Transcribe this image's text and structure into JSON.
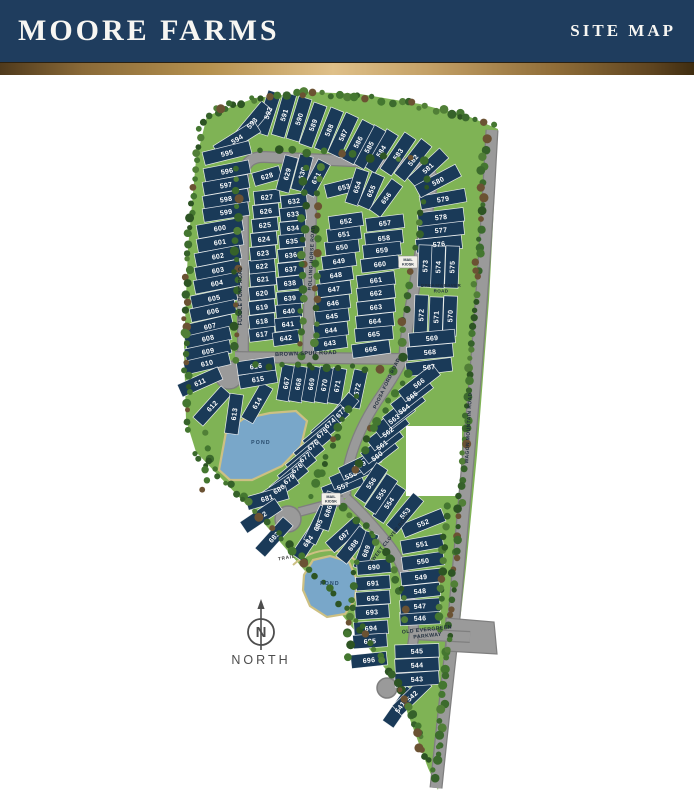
{
  "header": {
    "title": "MOORE FARMS",
    "subtitle": "SITE MAP"
  },
  "colors": {
    "header_bg": "#1f3d5e",
    "lot_fill": "#1a3a58",
    "lot_line": "#ffffff",
    "road": "#9a9a9a",
    "road_edge": "#7f7f7f",
    "grass": "#7fb355",
    "pond": "#79a7c9",
    "pond_edge": "#cdc083",
    "label_dark": "#1f2d3c",
    "compass": "#4d4d4d",
    "gold": "#c9a56b"
  },
  "map": {
    "north_label": "NORTH",
    "pond_label": "POND",
    "trail_label": "TRAIL",
    "mail_kiosk_label": "MAIL KIOSK",
    "roads": [
      {
        "id": "fuddle-pond-road",
        "name": "FUDDLE POND ROAD"
      },
      {
        "id": "rolling-horse-road",
        "name": "ROLLING HORSE ROAD"
      },
      {
        "id": "brown-spur-road",
        "name": "BROWN SPUR ROAD"
      },
      {
        "id": "poosa-ford-road",
        "name": "POOSA FORD ROAD"
      },
      {
        "id": "dreamweaver-road",
        "name": "DREAMWEAVER ROAD"
      },
      {
        "id": "wagon-mountain-road",
        "name": "WAGON MOUNTAIN ROAD"
      },
      {
        "id": "sweet-clover-road",
        "name": "SWEET CLOVER ROAD"
      },
      {
        "id": "old-evergreen-parkway",
        "name": "OLD EVERGREEN PARKWAY"
      }
    ],
    "blocks": [
      {
        "id": "northwest-arc",
        "lots": [
          590,
          591,
          592,
          593,
          594,
          595
        ]
      },
      {
        "id": "west-column",
        "lots": [
          596,
          597,
          598,
          599,
          600,
          601,
          602,
          603,
          604,
          605,
          606,
          607,
          608,
          609,
          610,
          611
        ]
      },
      {
        "id": "west-culdesac",
        "lots": [
          612,
          613,
          614,
          615,
          616
        ]
      },
      {
        "id": "north-arc",
        "lots": [
          581,
          582,
          583,
          584,
          585,
          586,
          587,
          588,
          589
        ]
      },
      {
        "id": "northeast-column",
        "lots": [
          576,
          577,
          578,
          579,
          580
        ]
      },
      {
        "id": "dreamweaver-north",
        "lots": [
          573,
          574,
          575
        ]
      },
      {
        "id": "dreamweaver-south",
        "lots": [
          570,
          571,
          572
        ]
      },
      {
        "id": "east-column",
        "lots": [
          567,
          568,
          569
        ]
      },
      {
        "id": "poosa-east-diagonal",
        "lots": [
          557,
          558,
          559,
          560,
          561,
          562,
          563,
          564,
          565,
          566
        ]
      },
      {
        "id": "sweet-clover-east",
        "lots": [
          546,
          547,
          548,
          549,
          550,
          551,
          552,
          553,
          554,
          555,
          556
        ]
      },
      {
        "id": "south-parkway",
        "lots": [
          541,
          542,
          543,
          544,
          545
        ]
      },
      {
        "id": "inner-west-left-col",
        "lots": [
          617,
          618,
          619,
          620,
          621,
          622,
          623,
          624,
          625,
          626,
          627,
          628
        ]
      },
      {
        "id": "inner-west-right-col",
        "lots": [
          629,
          630,
          631,
          632,
          633,
          634,
          635,
          636,
          637,
          638,
          639,
          640,
          641,
          642
        ]
      },
      {
        "id": "inner-east-left-col",
        "lots": [
          643,
          644,
          645,
          646,
          647,
          648,
          649,
          650,
          651,
          652,
          653
        ]
      },
      {
        "id": "inner-east-right-col",
        "lots": [
          654,
          655,
          656,
          657,
          658,
          659,
          660,
          661,
          662,
          663,
          664,
          665,
          666
        ]
      },
      {
        "id": "brown-spur-south",
        "lots": [
          667,
          668,
          669,
          670,
          671,
          672
        ]
      },
      {
        "id": "poosa-west-diagonal",
        "lots": [
          673,
          674,
          675,
          676,
          677,
          678,
          679
        ]
      },
      {
        "id": "southwest-culdesac",
        "lots": [
          680,
          681,
          682,
          683,
          684,
          685,
          686,
          687,
          688,
          689
        ]
      },
      {
        "id": "south-column",
        "lots": [
          690,
          691,
          692,
          693,
          694,
          695,
          696
        ]
      }
    ]
  }
}
